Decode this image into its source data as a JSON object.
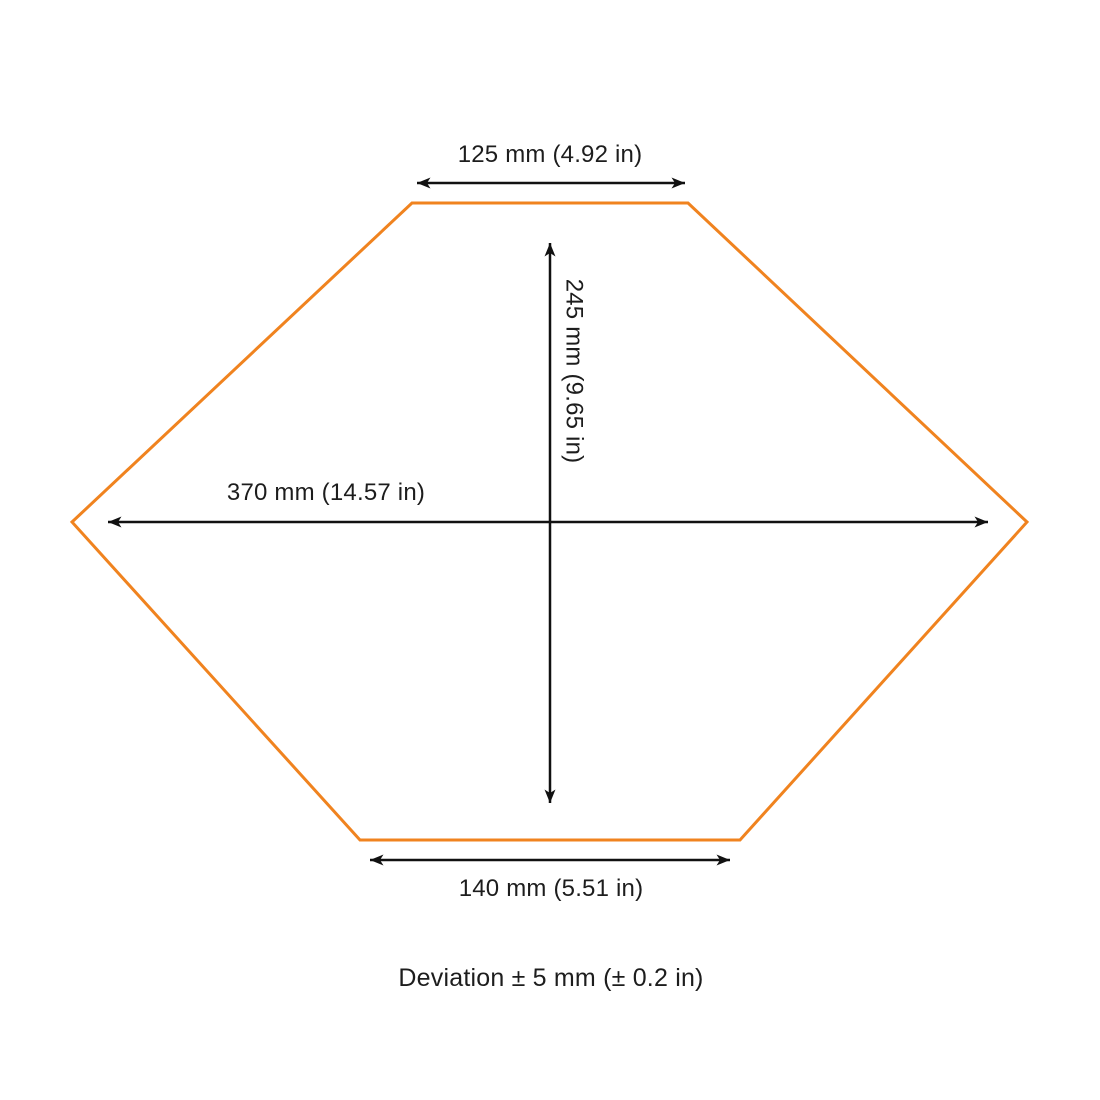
{
  "diagram": {
    "shape": "hexagon-outline",
    "labels": {
      "top_width": "125 mm (4.92 in)",
      "height": "245 mm (9.65 in)",
      "max_width": "370 mm (14.57 in)",
      "bottom_width": "140 mm (5.51 in)"
    },
    "note": "Deviation ± 5 mm (± 0.2 in)",
    "colors": {
      "outline": "#F0831F",
      "dimension": "#111111",
      "text": "#1D1D1D",
      "background": "#FFFFFF"
    }
  }
}
